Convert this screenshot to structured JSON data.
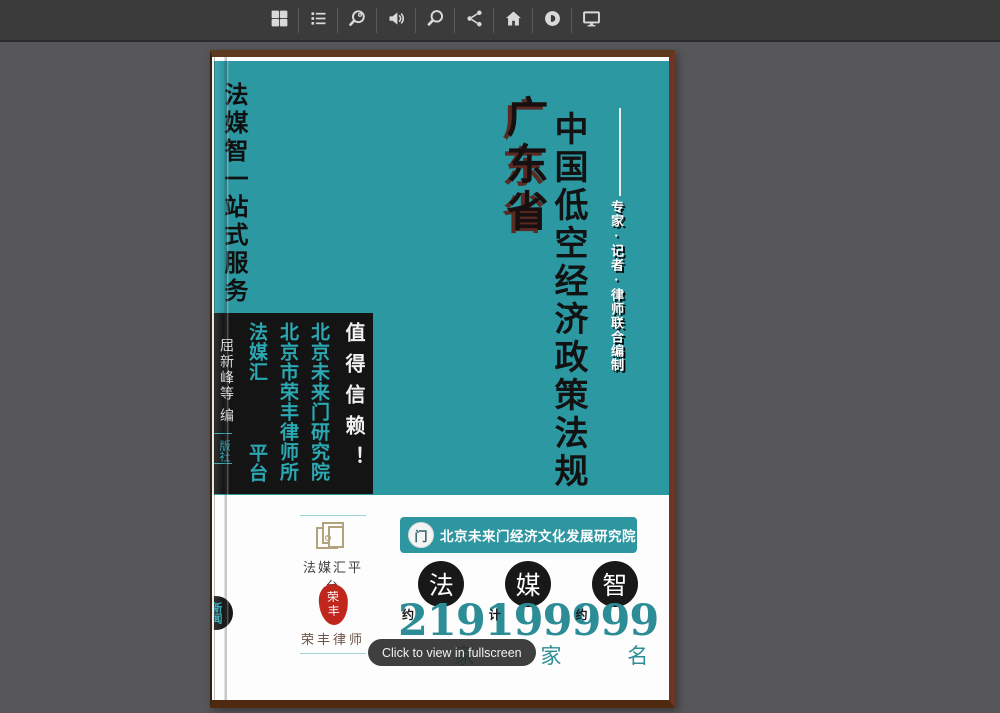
{
  "toolbar": {
    "icons": [
      "thumbnails",
      "table-of-contents",
      "zoom",
      "sound",
      "search",
      "share",
      "home",
      "autoplay",
      "fullscreen"
    ]
  },
  "tooltip": "Click to view in fullscreen",
  "cover": {
    "spine_service_title": "法媒智一站式服务",
    "region": "广东省",
    "title": "中国低空经济政策法规",
    "editors_credit": "专家·记者·律师联合编制",
    "spine_authors": "屈新峰等",
    "spine_role": "编",
    "spine_publisher": "版社",
    "trust_box": {
      "headline": "值得信赖！",
      "org_institute": "北京未来门研究院",
      "org_lawfirm": "北京市荣丰律师所",
      "org_platform_top": "法媒汇",
      "org_platform_bottom": "平台"
    },
    "edge_badge": "新闻",
    "footer": {
      "platform_logo_label": "法媒汇平台",
      "seal_top": "荣",
      "seal_bottom": "丰",
      "seal_label": "荣丰律师",
      "banner_glyph": "门",
      "banner_text": "北京未来门经济文化发展研究院",
      "stats": [
        {
          "badge": "法",
          "prefix": "约",
          "value": "219",
          "unit": "家"
        },
        {
          "badge": "媒",
          "prefix": "计",
          "value": "199",
          "unit": "家"
        },
        {
          "badge": "智",
          "prefix": "约",
          "value": "999",
          "unit": "名"
        }
      ]
    }
  },
  "colors": {
    "background": "#57575a",
    "toolbar_bg": "#3b3b3b",
    "cover_teal": "#2b98a2",
    "accent_teal": "#2ba8b2",
    "stat_teal": "#2d8d96",
    "trust_box_black": "#141414",
    "border_brown_top": "#5c3a1d",
    "border_brown_right": "#6e3526",
    "seal_red": "#c0261c"
  }
}
